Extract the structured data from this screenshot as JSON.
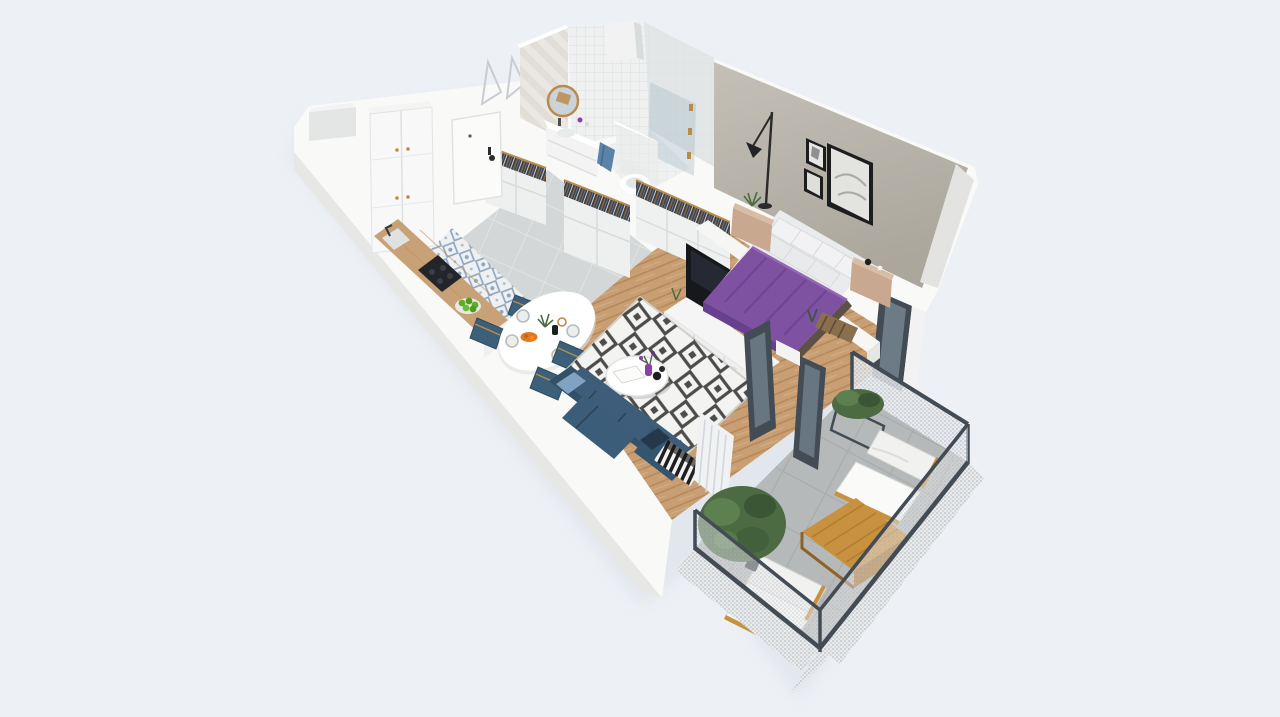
{
  "scene": {
    "type": "isometric-3d-floorplan-render",
    "description": "3D cutaway render of a one-bedroom apartment with balcony, viewed from above at an angle. No text labels are rendered.",
    "rooms": [
      {
        "name": "hallway",
        "floor": "gray ceramic tile",
        "furniture": [
          "entry-door",
          "tall-white-wardrobe",
          "shoe-cabinet-with-clothes-rail",
          "wall-niche"
        ]
      },
      {
        "name": "bathroom",
        "floor": "light tile",
        "furniture": [
          "round-gold-mirror",
          "white-vanity-sink",
          "toilet",
          "glass-shower",
          "blue-towel",
          "herringbone-tile-wall",
          "white-square-tile-wall",
          "duct-pillar"
        ]
      },
      {
        "name": "kitchen",
        "floor": "blue-white patterned tile",
        "furniture": [
          "counter-wood-top",
          "black-cooktop",
          "sink-faucet",
          "green-fruit-bowl"
        ]
      },
      {
        "name": "dining-area",
        "floor": "herringbone wood",
        "furniture": [
          "oval-white-table",
          "blue-upholstered-chairs",
          "plates",
          "orange-fruit-bowl",
          "plant-centerpiece"
        ]
      },
      {
        "name": "living-room",
        "floor": "herringbone wood",
        "furniture": [
          "navy-corner-sofa",
          "light-blue-pillow",
          "diamond-pattern-rug",
          "round-white-coffee-table",
          "purple-vase",
          "white-tv-sideboard",
          "flat-tv",
          "white-curtain",
          "striped-radiator",
          "balcony-glass-doors"
        ]
      },
      {
        "name": "bedroom",
        "floor": "herringbone wood",
        "furniture": [
          "double-bed-purple-bedding",
          "white-pillows",
          "wood-nightstand-left-with-plant",
          "wood-nightstand-right-with-clock",
          "arc-floor-lamp",
          "three-wall-pictures",
          "open-wardrobes-with-hanging-clothes",
          "foot-bench",
          "balcony-door"
        ]
      },
      {
        "name": "balcony",
        "floor": "gray concrete tile",
        "furniture": [
          "mesh-railing",
          "lounge-chair-north",
          "lounge-chair-south",
          "wood-coffee-table",
          "potted-tree",
          "metal-planter-with-plant"
        ]
      }
    ]
  },
  "palette": {
    "background": "#edf0f4",
    "shadow": "#d9dfe8",
    "wall_white": "#f9f9f8",
    "wall_shade": "#e7e8e6",
    "wall_greige": "#b8b4ab",
    "wall_greige_dark": "#a9a59b",
    "hall_tile": "#d4d7d7",
    "kitchen_tile": "#eef0f2",
    "kitchen_tile_accent": "#7e99b4",
    "bath_tile": "#eff0f0",
    "herring_wall": "#e9e6e1",
    "wood_floor": "#c89e74",
    "rug_base": "#f3f3f1",
    "rug_pattern": "#2e2e2e",
    "sofa": "#31506a",
    "sofa_cushion": "#3d5d7a",
    "sofa_pillow_light": "#7fa3c0",
    "chair_blue": "#3d6078",
    "gold": "#b98c4e",
    "bed_purple": "#7e51a1",
    "bed_purple_dark": "#67418d",
    "pillow_white": "#f2f2f4",
    "mattress": "#e9ebec",
    "tv_black": "#17181c",
    "console_white": "#f4f5f4",
    "counter_wood": "#c9a176",
    "cooktop_black": "#23252a",
    "apple_green": "#5fae28",
    "plant_green": "#4c6b42",
    "plant_green_dark": "#3a5634",
    "balcony_floor": "#b6b9ba",
    "balcony_wood": "#c8913f",
    "balcony_wood_dark": "#a87430",
    "mesh_light": "#e9ebed",
    "frame_dark": "#434c55",
    "clothes_dark": "#3a4049",
    "towel_blue": "#5b82a8",
    "vase_purple": "#8b3fa8",
    "orange_fruit": "#e2791f",
    "nightstand_wood": "#c8a98f",
    "curtain": "#eff1f2",
    "door_white": "#fbfbfa",
    "glass": "#9fb6c2"
  }
}
